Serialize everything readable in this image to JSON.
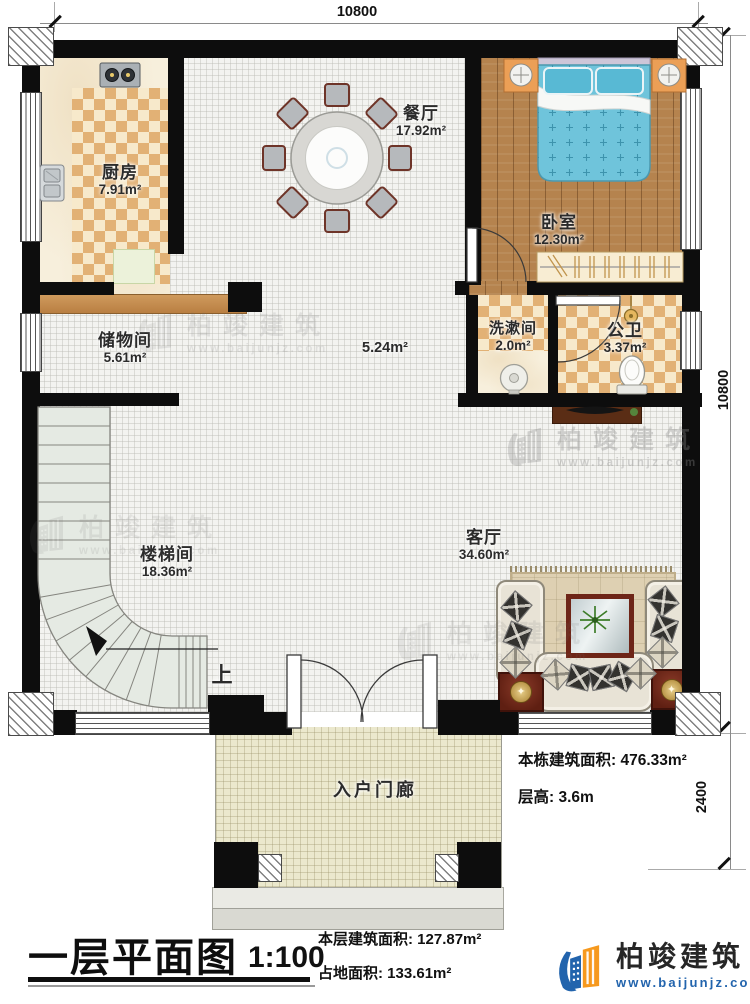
{
  "dims": {
    "width_top": "10800",
    "height_right": "10800",
    "porch_depth": "2400"
  },
  "rooms": {
    "kitchen": {
      "name": "厨房",
      "area": "7.91m²"
    },
    "dining": {
      "name": "餐厅",
      "area": "17.92m²"
    },
    "bedroom": {
      "name": "卧室",
      "area": "12.30m²"
    },
    "storage": {
      "name": "储物间",
      "area": "5.61m²"
    },
    "washroom": {
      "name": "洗漱间",
      "area": "2.0m²"
    },
    "bathroom": {
      "name": "公卫",
      "area": "3.37m²"
    },
    "hallway": {
      "area": "5.24m²"
    },
    "stairwell": {
      "name": "楼梯间",
      "area": "18.36m²",
      "direction": "上"
    },
    "living": {
      "name": "客厅",
      "area": "34.60m²"
    },
    "porch": {
      "name": "入户门廊"
    }
  },
  "side_info": {
    "building_area_label": "本栋建筑面积:",
    "building_area_value": "476.33m²",
    "floor_height_label": "层高:",
    "floor_height_value": "3.6m"
  },
  "title_block": {
    "title": "一层平面图",
    "scale": "1:100",
    "floor_area_label": "本层建筑面积:",
    "floor_area_value": "127.87m²",
    "land_area_label": "占地面积:",
    "land_area_value": "133.61m²"
  },
  "brand": {
    "name": "柏竣建筑",
    "site": "www.baijunjz.com"
  },
  "watermark": {
    "name": "柏竣建筑",
    "site": "www.baijunjz.com"
  },
  "colors": {
    "wall": "#0d0d0d",
    "checker_tan": "#e2b175",
    "wood": "#b5834e",
    "bed_blue": "#6fc4db",
    "brand_blue": "#2264ad",
    "brand_orange": "#f6991e"
  }
}
